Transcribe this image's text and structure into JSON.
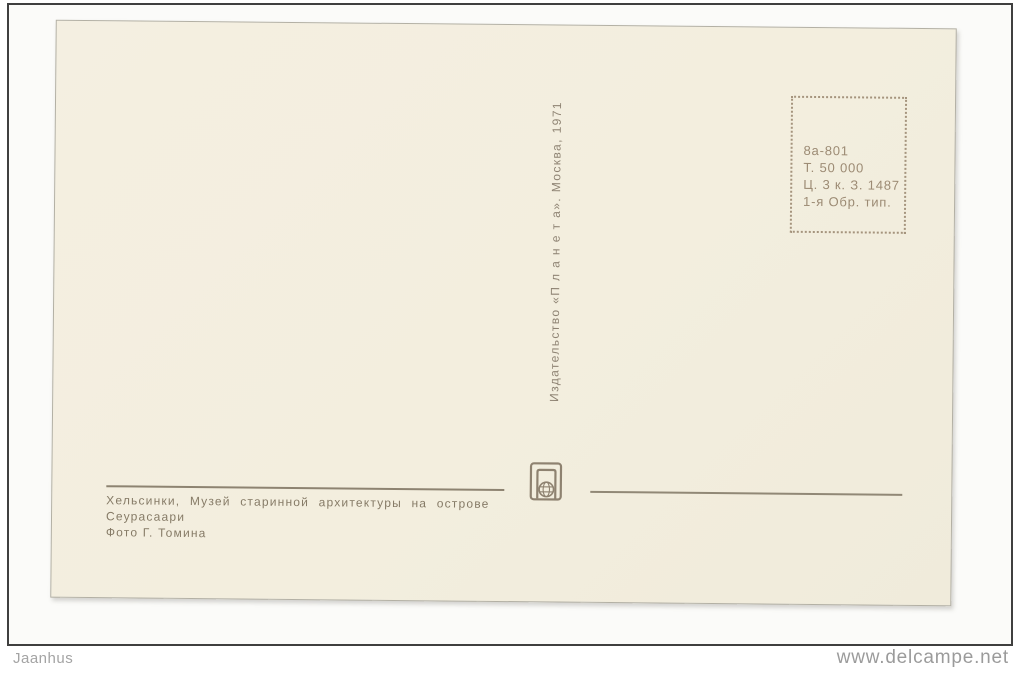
{
  "postcard": {
    "paper_color": "#f3eede",
    "ink_color": "#8e8373",
    "stamp_box": {
      "lines": [
        "8а-801",
        "Т. 50 000",
        "Ц. 3 к. З. 1487",
        "1-я Обр. тип."
      ]
    },
    "publisher_line": "Издательство «П л а н е т а».  Москва, 1971",
    "logo": {
      "icon": "planeta-globe-logo"
    },
    "caption": {
      "line1": "Хельсинки, Музей старинной архитектуры на острове",
      "line2": "Сеурасаари",
      "line3": "Фото Г. Томина"
    }
  },
  "watermarks": {
    "left": "Jaanhus",
    "right": "www.delcampe.net"
  }
}
